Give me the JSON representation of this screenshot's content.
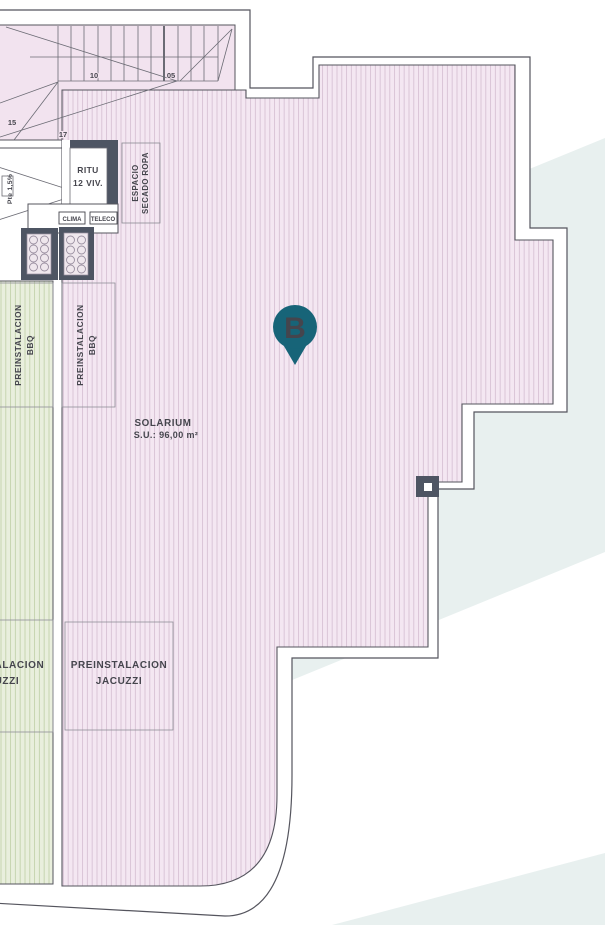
{
  "marker": {
    "letter": "B"
  },
  "solarium": {
    "title": "SOLARIUM",
    "area": "S.U.: 96,00 m²"
  },
  "zones": {
    "bbq_green": {
      "line1": "PREINSTALACION",
      "line2": "BBQ"
    },
    "bbq_pink": {
      "line1": "PREINSTALACION",
      "line2": "BBQ"
    },
    "jacuzzi_green": {
      "line1": "PREINSTALACION",
      "line2": "JACUZZI"
    },
    "jacuzzi_pink": {
      "line1": "PREINSTALACION",
      "line2": "JACUZZI"
    },
    "laundry": {
      "line1": "ESPACIO",
      "line2": "SECADO ROPA"
    },
    "ritu": {
      "line1": "RITU",
      "line2": "12 VIV."
    },
    "ramp": {
      "label": "Pte 1,5%"
    },
    "clima": {
      "label": "CLIMA"
    },
    "teleco": {
      "label": "TELECO"
    }
  },
  "stairs": {
    "n05": "05",
    "n10": "10",
    "n15": "15",
    "n17": "17"
  },
  "colors": {
    "pink": "#f4e7f2",
    "green": "#e9efdd",
    "teal_background": "#e8f0ef",
    "marker_teal": "#176478",
    "wall": "#55555e",
    "dark_fixture": "#4e5563"
  }
}
